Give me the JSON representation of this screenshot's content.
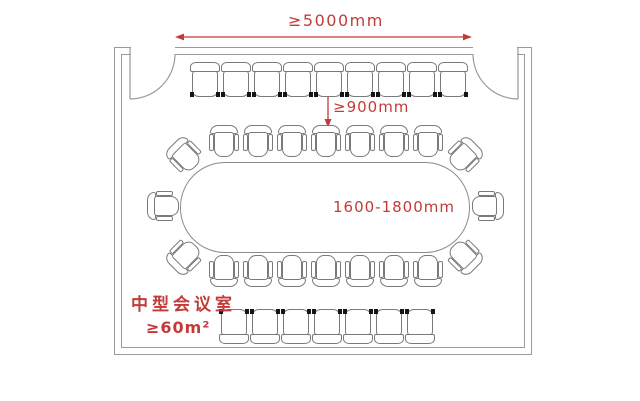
{
  "plan": {
    "room_label": "中型会议室",
    "room_area": "≥60m²",
    "dimensions": {
      "room_width": "≥5000mm",
      "front_clearance": "≥900mm",
      "table_width": "1600-1800mm"
    },
    "seating": {
      "top_wall_row": 9,
      "table_top_row": 7,
      "table_bottom_row": 7,
      "table_left": 1,
      "table_right": 1,
      "table_corners": 4,
      "bottom_back_row": 7
    },
    "colors": {
      "dimension_red": "#c23b38",
      "wall_gray": "#9a9a9a",
      "chair_gray": "#7a7a7a",
      "background": "#ffffff"
    }
  }
}
